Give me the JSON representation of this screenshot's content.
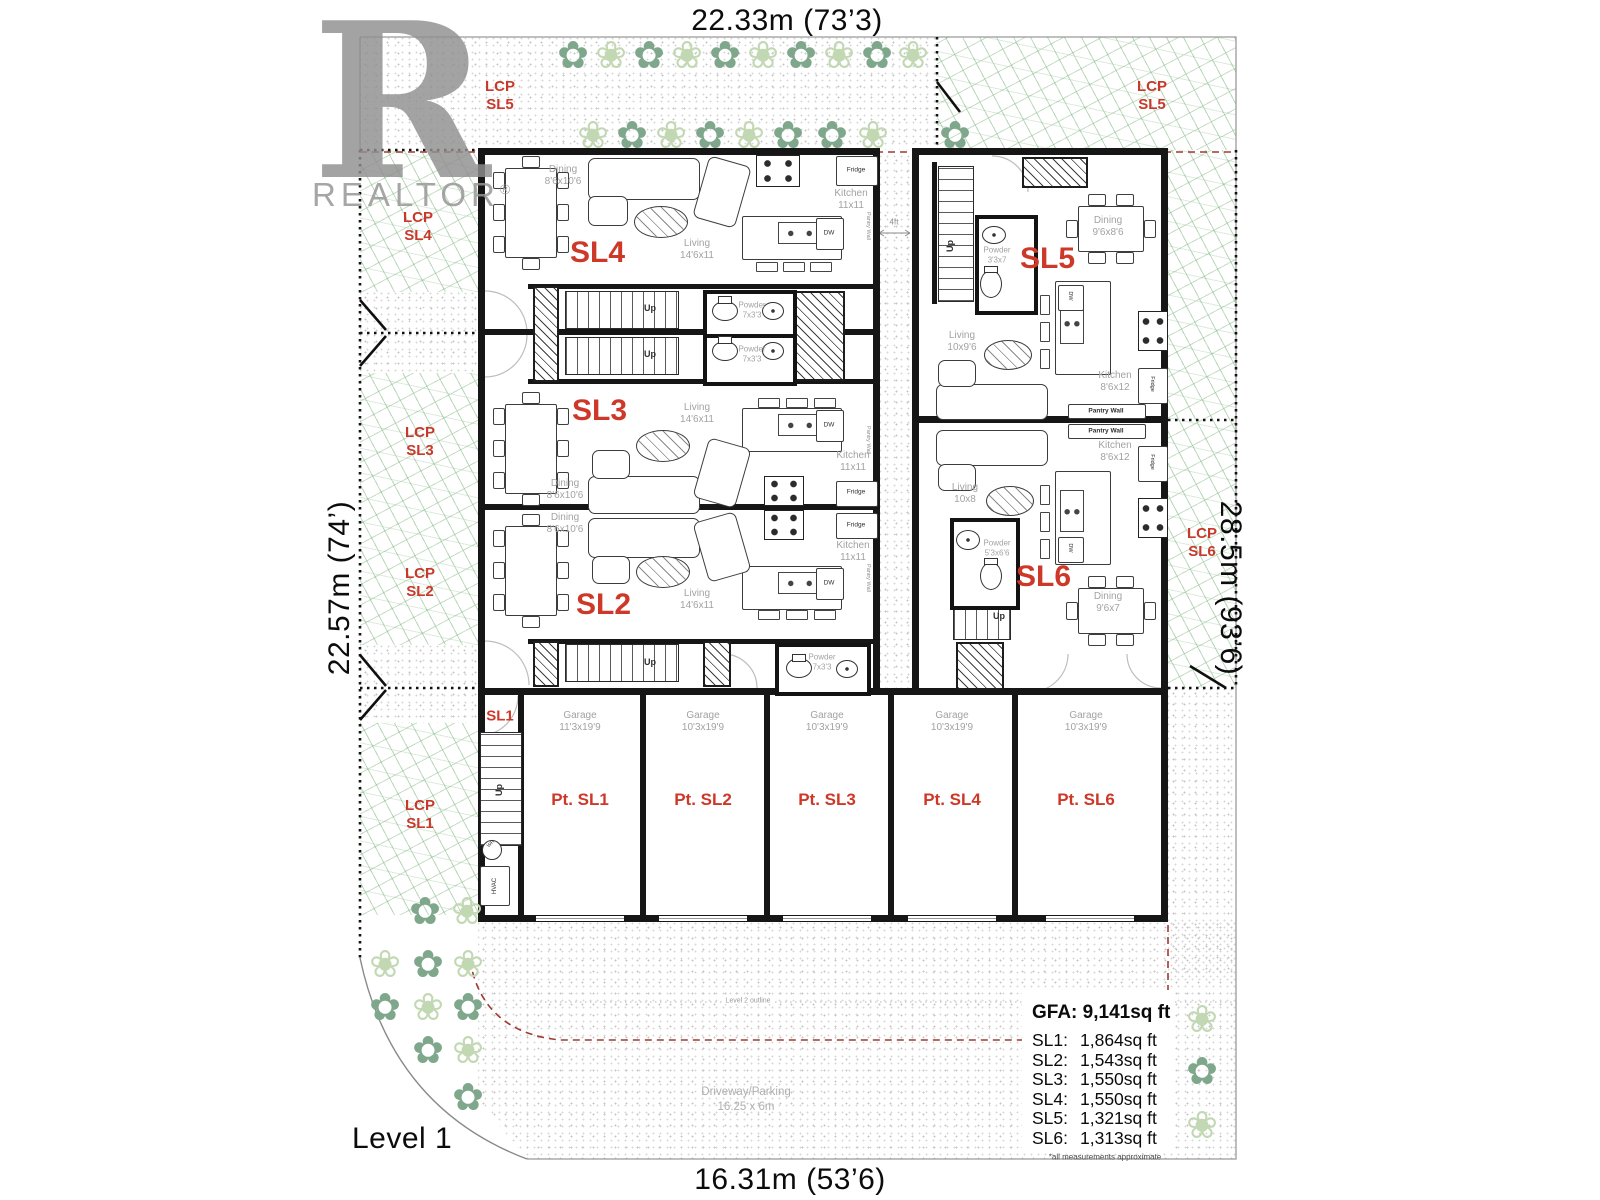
{
  "watermark": {
    "logo_letter": "R",
    "brand": "REALTOR",
    "registered_mark": "®"
  },
  "dimensions": {
    "top": "22.33m (73’3)",
    "bottom": "16.31m (53’6)",
    "left": "22.57m (74’)",
    "right": "28.5m (93’6)"
  },
  "level_label": "Level 1",
  "gap_dim": "4ft",
  "fixtures": {
    "up": "Up",
    "fridge": "Fridge",
    "dw": "DW",
    "pantry": "Pantry Wall",
    "wh": "WH",
    "hvac": "HVAC"
  },
  "lcp": {
    "top_left": {
      "line1": "LCP",
      "line2": "SL5"
    },
    "top_right": {
      "line1": "LCP",
      "line2": "SL5"
    },
    "sl4": {
      "line1": "LCP",
      "line2": "SL4"
    },
    "sl3": {
      "line1": "LCP",
      "line2": "SL3"
    },
    "sl2": {
      "line1": "LCP",
      "line2": "SL2"
    },
    "sl1": {
      "line1": "LCP",
      "line2": "SL1"
    },
    "sl6": {
      "line1": "LCP",
      "line2": "SL6"
    }
  },
  "units": {
    "sl1": {
      "name": "SL1"
    },
    "sl2": {
      "name": "SL2",
      "dining": {
        "label": "Dining",
        "dim": "8'6x10'6"
      },
      "living": {
        "label": "Living",
        "dim": "14'6x11"
      },
      "kitchen": {
        "label": "Kitchen",
        "dim": "11x11"
      },
      "powder": {
        "label": "Powder",
        "dim": "7x3'3"
      }
    },
    "sl3": {
      "name": "SL3",
      "dining": {
        "label": "Dining",
        "dim": "8'6x10'6"
      },
      "living": {
        "label": "Living",
        "dim": "14'6x11"
      },
      "kitchen": {
        "label": "Kitchen",
        "dim": "11x11"
      },
      "powder": {
        "label": "Powder",
        "dim": "7x3'3"
      }
    },
    "sl4": {
      "name": "SL4",
      "dining": {
        "label": "Dining",
        "dim": "8'6x10'6"
      },
      "living": {
        "label": "Living",
        "dim": "14'6x11"
      },
      "kitchen": {
        "label": "Kitchen",
        "dim": "11x11"
      },
      "powder": {
        "label": "Powder",
        "dim": "7x3'3"
      }
    },
    "sl5": {
      "name": "SL5",
      "dining": {
        "label": "Dining",
        "dim": "9'6x8'6"
      },
      "living": {
        "label": "Living",
        "dim": "10x9'6"
      },
      "kitchen": {
        "label": "Kitchen",
        "dim": "8'6x12"
      },
      "powder": {
        "label": "Powder",
        "dim": "3'3x7"
      }
    },
    "sl6": {
      "name": "SL6",
      "dining": {
        "label": "Dining",
        "dim": "9'6x7"
      },
      "living": {
        "label": "Living",
        "dim": "10x8"
      },
      "kitchen": {
        "label": "Kitchen",
        "dim": "8'6x12"
      },
      "powder": {
        "label": "Powder",
        "dim": "5'3x6'6"
      }
    }
  },
  "garages": {
    "label": "Garage",
    "bays": [
      {
        "stall": "Pt. SL1",
        "dim": "11'3x19'9"
      },
      {
        "stall": "Pt. SL2",
        "dim": "10'3x19'9"
      },
      {
        "stall": "Pt. SL3",
        "dim": "10'3x19'9"
      },
      {
        "stall": "Pt. SL4",
        "dim": "10'3x19'9"
      },
      {
        "stall": "Pt. SL6",
        "dim": "10'3x19'9"
      }
    ]
  },
  "driveway": {
    "line1": "Driveway/Parking",
    "line2": "16.25 x 6m"
  },
  "level2_outline_label": "Level 2 outline",
  "area_summary": {
    "gfa_label": "GFA:",
    "gfa_value": "9,141sq ft",
    "rows": [
      {
        "label": "SL1:",
        "value": "1,864sq ft"
      },
      {
        "label": "SL2:",
        "value": "1,543sq ft"
      },
      {
        "label": "SL3:",
        "value": "1,550sq ft"
      },
      {
        "label": "SL4:",
        "value": "1,550sq ft"
      },
      {
        "label": "SL5:",
        "value": "1,321sq ft"
      },
      {
        "label": "SL6:",
        "value": "1,313sq ft"
      }
    ],
    "footnote": "*all measurements approximate"
  }
}
